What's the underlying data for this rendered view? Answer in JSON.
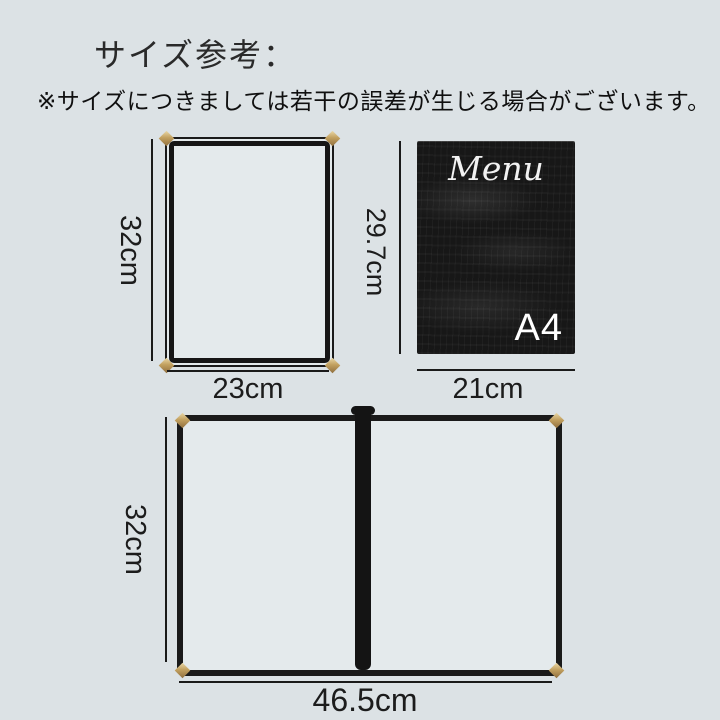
{
  "page": {
    "title": "サイズ参考：",
    "disclaimer": "※サイズにつきましては若干の誤差が生じる場合がございます。",
    "background_color": "#dce2e5"
  },
  "single_cover": {
    "height_label": "32cm",
    "width_label": "23cm"
  },
  "a4_reference": {
    "board_title": "Menu",
    "size_badge": "A4",
    "height_label": "29.7cm",
    "width_label": "21cm",
    "board_color": "#171717",
    "board_text_color": "#f2f2f2"
  },
  "double_cover": {
    "height_label": "32cm",
    "width_label": "46.5cm"
  },
  "colors": {
    "frame": "#1a1a1a",
    "corner_gold": "#c2a05f",
    "dimension_line": "#1a1a1a",
    "label_text": "#1c1c1c",
    "interior": "#e4eaec"
  }
}
